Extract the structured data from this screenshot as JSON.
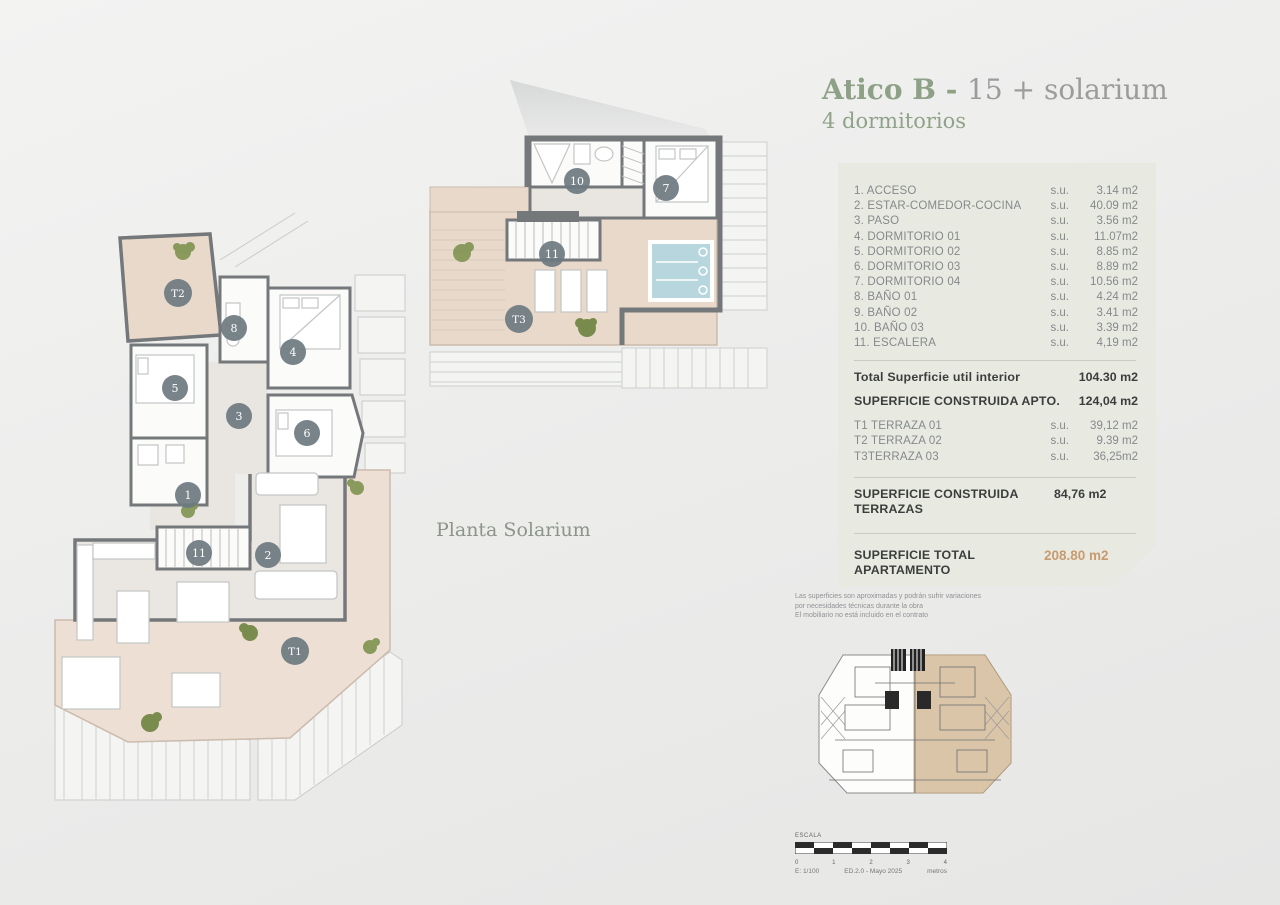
{
  "header": {
    "title_bold": "Atico B - ",
    "title_light": "15 + solarium",
    "subtitle": "4 dormitorios"
  },
  "plan_labels": {
    "solarium": "Planta Solarium"
  },
  "rooms": {
    "items": [
      {
        "label": "1. ACCESO",
        "su": "s.u.",
        "value": "3.14 m2"
      },
      {
        "label": "2. ESTAR-COMEDOR-COCINA",
        "su": "s.u.",
        "value": "40.09 m2"
      },
      {
        "label": "3. PASO",
        "su": "s.u.",
        "value": "3.56 m2"
      },
      {
        "label": "4. DORMITORIO 01",
        "su": "s.u.",
        "value": "11.07m2"
      },
      {
        "label": "5. DORMITORIO 02",
        "su": "s.u.",
        "value": "8.85 m2"
      },
      {
        "label": "6. DORMITORIO 03",
        "su": "s.u.",
        "value": "8.89 m2"
      },
      {
        "label": "7. DORMITORIO 04",
        "su": "s.u.",
        "value": "10.56 m2"
      },
      {
        "label": "8. BAÑO 01",
        "su": "s.u.",
        "value": "4.24 m2"
      },
      {
        "label": "9. BAÑO 02",
        "su": "s.u.",
        "value": "3.41 m2"
      },
      {
        "label": "10. BAÑO 03",
        "su": "s.u.",
        "value": "3.39 m2"
      },
      {
        "label": "11. ESCALERA",
        "su": "s.u.",
        "value": "4,19 m2"
      }
    ]
  },
  "totals": {
    "util_label": "Total Superficie util interior",
    "util_value": "104.30 m2",
    "construida_label": "SUPERFICIE CONSTRUIDA APTO.",
    "construida_value": "124,04 m2",
    "terrazas": [
      {
        "label": "T1 TERRAZA 01",
        "su": "s.u.",
        "value": "39,12 m2"
      },
      {
        "label": "T2 TERRAZA 02",
        "su": "s.u.",
        "value": "9.39 m2"
      },
      {
        "label": "T3TERRAZA 03",
        "su": "s.u.",
        "value": "36,25m2"
      }
    ],
    "terrazas_construida_label": "SUPERFICIE CONSTRUIDA TERRAZAS",
    "terrazas_construida_value": "84,76 m2",
    "total_label": "SUPERFICIE TOTAL APARTAMENTO",
    "total_value": "208.80 m2"
  },
  "disclaimer": {
    "line1": "Las superficies son aproximadas y podrán sufrir variaciones",
    "line2": "por necesidades técnicas durante la obra",
    "line3": "El mobiliario no está incluido en el contrato"
  },
  "scalebar": {
    "escala": "ESCALA",
    "ticks": [
      "0",
      "1",
      "2",
      "3",
      "4"
    ],
    "scale": "E: 1/100",
    "edition": "ED.2.0 - Mayo 2025",
    "units": "metros"
  },
  "plan_main": {
    "markers": [
      {
        "label": "T2"
      },
      {
        "label": "8"
      },
      {
        "label": "4"
      },
      {
        "label": "5"
      },
      {
        "label": "3"
      },
      {
        "label": "6"
      },
      {
        "label": "1"
      },
      {
        "label": "11"
      },
      {
        "label": "2"
      },
      {
        "label": "T1"
      }
    ]
  },
  "plan_solarium": {
    "markers": [
      {
        "label": "10"
      },
      {
        "label": "7"
      },
      {
        "label": "11"
      },
      {
        "label": "T3"
      }
    ]
  },
  "colors": {
    "sage_green": "#8ea187",
    "gray_title": "#9c9c9b",
    "panel_bg": "#e8eae2",
    "accent_orange": "#c99a6e",
    "wall_gray": "#75787a",
    "terrace_beige": "#e9d9ca",
    "terrace_pink": "#eedfd5",
    "pool_blue": "#b7d6dd",
    "keyplan_tan": "#d8c1a2",
    "marker_slate": "#6c7980"
  }
}
